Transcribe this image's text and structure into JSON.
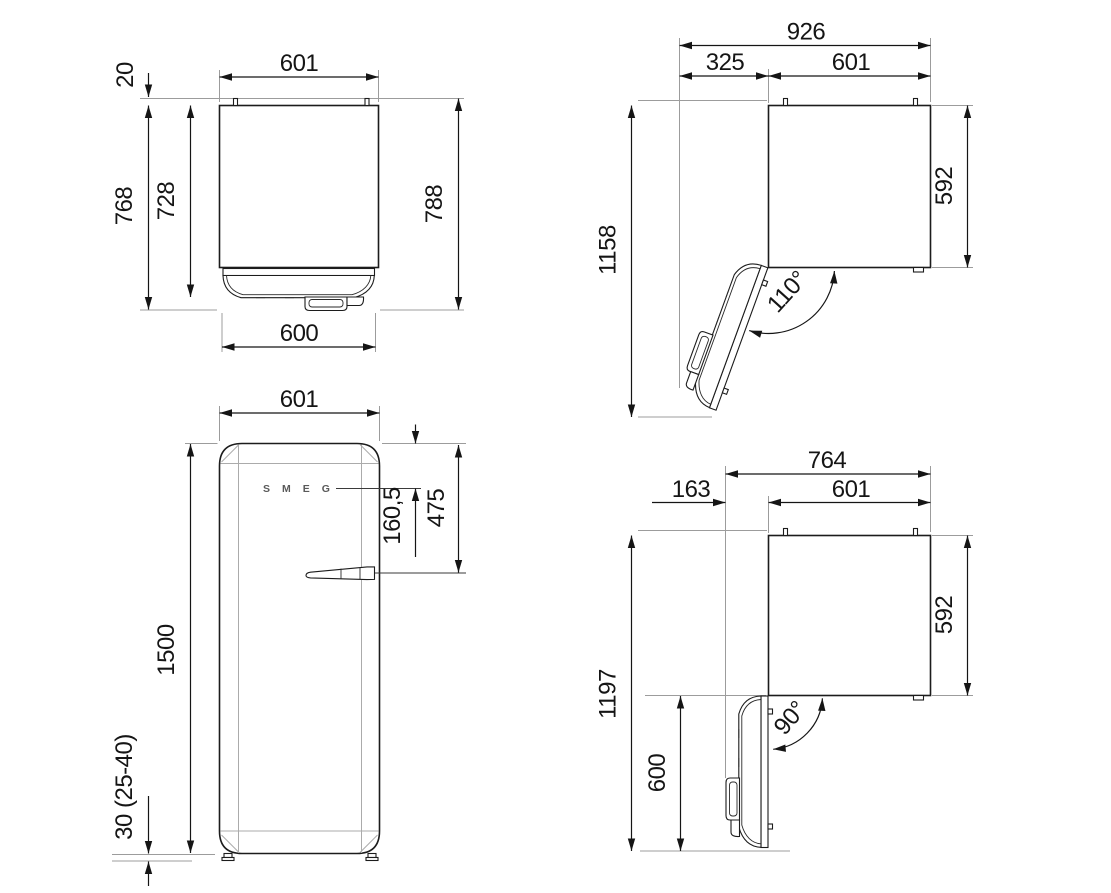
{
  "title": "Refrigerator dimension drawing",
  "brand": "SMEG",
  "views": {
    "top_closed": {
      "width_top": "601",
      "hinge_pin_offset": "20",
      "depth_with_door": "768",
      "cabinet_depth": "728",
      "total_depth": "788",
      "door_width": "600"
    },
    "top_open_110": {
      "overall_width": "926",
      "door_projection": "325",
      "cabinet_width": "601",
      "overall_depth": "1158",
      "cabinet_depth": "592",
      "door_angle": "110°"
    },
    "front": {
      "width": "601",
      "handle_from_top": "475",
      "logo_from_top": "160,5",
      "height": "1500",
      "feet_height": "30 (25-40)"
    },
    "top_open_90": {
      "overall_width": "764",
      "door_projection": "163",
      "cabinet_width": "601",
      "overall_depth": "1197",
      "open_door_depth": "600",
      "cabinet_depth": "592",
      "door_angle": "90°"
    }
  }
}
